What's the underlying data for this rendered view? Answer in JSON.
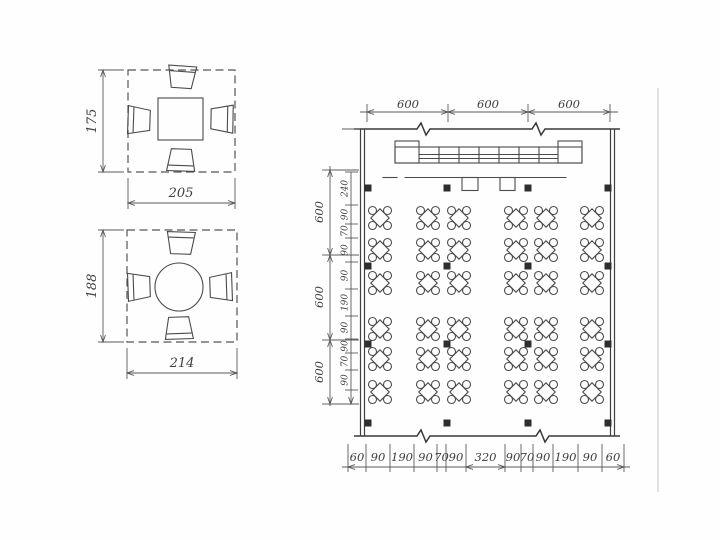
{
  "page": {
    "background": "#fefefe",
    "ink": "#3e3e3e"
  },
  "figure_square_table": {
    "height_dim": "175",
    "width_dim": "205"
  },
  "figure_round_table": {
    "height_dim": "188",
    "width_dim": "214"
  },
  "plan": {
    "top_dims": [
      "600",
      "600",
      "600"
    ],
    "left_outer_dims": [
      "600",
      "600",
      "600"
    ],
    "left_inner_dims": [
      "240",
      "90",
      "70",
      "90",
      "90",
      "190",
      "90",
      "90",
      "70",
      "90"
    ],
    "bottom_dims": [
      "60",
      "90",
      "190",
      "90",
      "70",
      "90",
      "320",
      "90",
      "70",
      "90",
      "190",
      "90",
      "60"
    ],
    "tables": {
      "rows": 6,
      "cols": 6,
      "symbol": "square-table-with-four-chairs"
    },
    "pillars": {
      "rows": 4,
      "cols": 4
    },
    "counter_cells": 7
  }
}
